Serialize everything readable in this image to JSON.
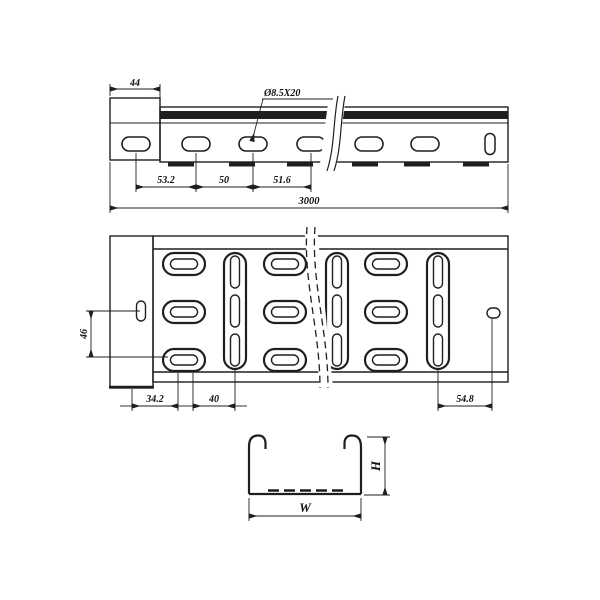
{
  "colors": {
    "line": "#1f1f1f",
    "background": "#ffffff"
  },
  "views": {
    "side": {
      "plate_width": "44",
      "slot_callout": "Ø8.5X20",
      "slot_pitch_dims": [
        "53.2",
        "50",
        "51.6"
      ],
      "overall_length": "3000"
    },
    "plan": {
      "row_spacing": "46",
      "offset_dims": [
        "34.2",
        "40"
      ],
      "end_offset": "54.8"
    },
    "section": {
      "width_symbol": "W",
      "height_symbol": "H"
    }
  }
}
